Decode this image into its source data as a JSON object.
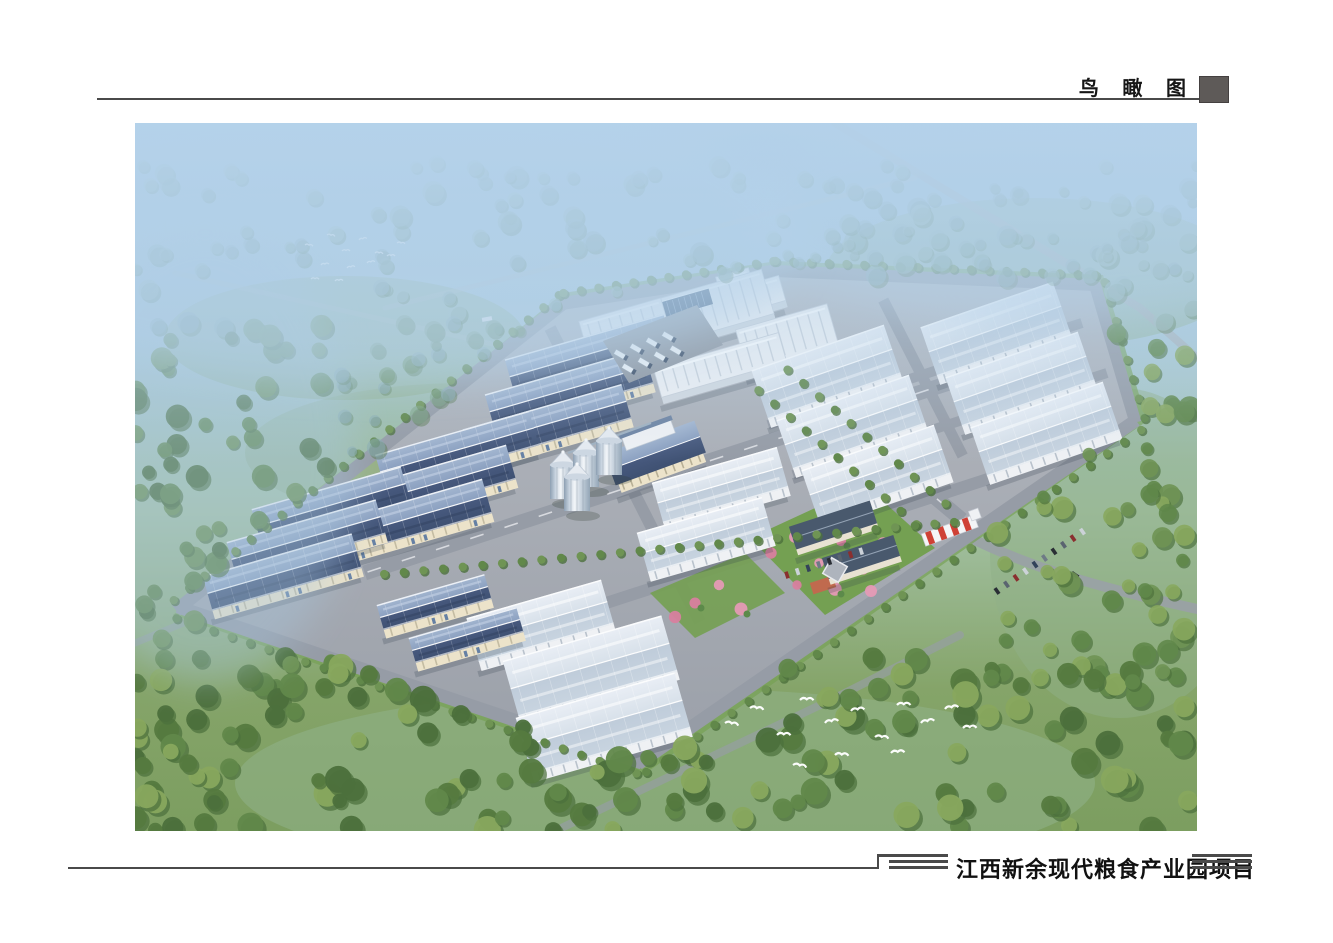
{
  "header": {
    "view_label": "鸟 瞰 图"
  },
  "footer": {
    "project_title": "江西新余现代粮食产业园项目"
  },
  "decor": {
    "rule_color": "#4a4a4a",
    "square_color": "#5e5a58"
  },
  "palette": {
    "sky_top": "#9fc3e0",
    "sky_mid": "#aac9d8",
    "ground_green": "#7c9e60",
    "meadow": "#8fb087",
    "mist_tree": "#87a9ae",
    "tree": "#61884a",
    "tree_dark": "#4c703c",
    "tree_light": "#88a85e",
    "apron_hi": "#b4b8bf",
    "apron_lo": "#9ba0a9",
    "road": "#969ca6",
    "roof_blue_hi": "#a3b6d0",
    "roof_blue_md": "#8ba0c0",
    "roof_blue_lo": "#47597e",
    "roof_light_hi": "#e9eef5",
    "roof_light_lo": "#bfccda",
    "wall_cream": "#ece3ca",
    "wall_white": "#eff1f4",
    "pilaster": "#c4bca2",
    "silo_hi": "#f2f5f8",
    "silo_lo": "#8d9fb2",
    "dark_roof": "#49596d",
    "gate_red": "#cf4136",
    "blossom": "#e59ab5",
    "blossom2": "#d87f9f",
    "lawn": "#74a052",
    "bird": "#ffffff",
    "haze": "#b5d2ea"
  }
}
